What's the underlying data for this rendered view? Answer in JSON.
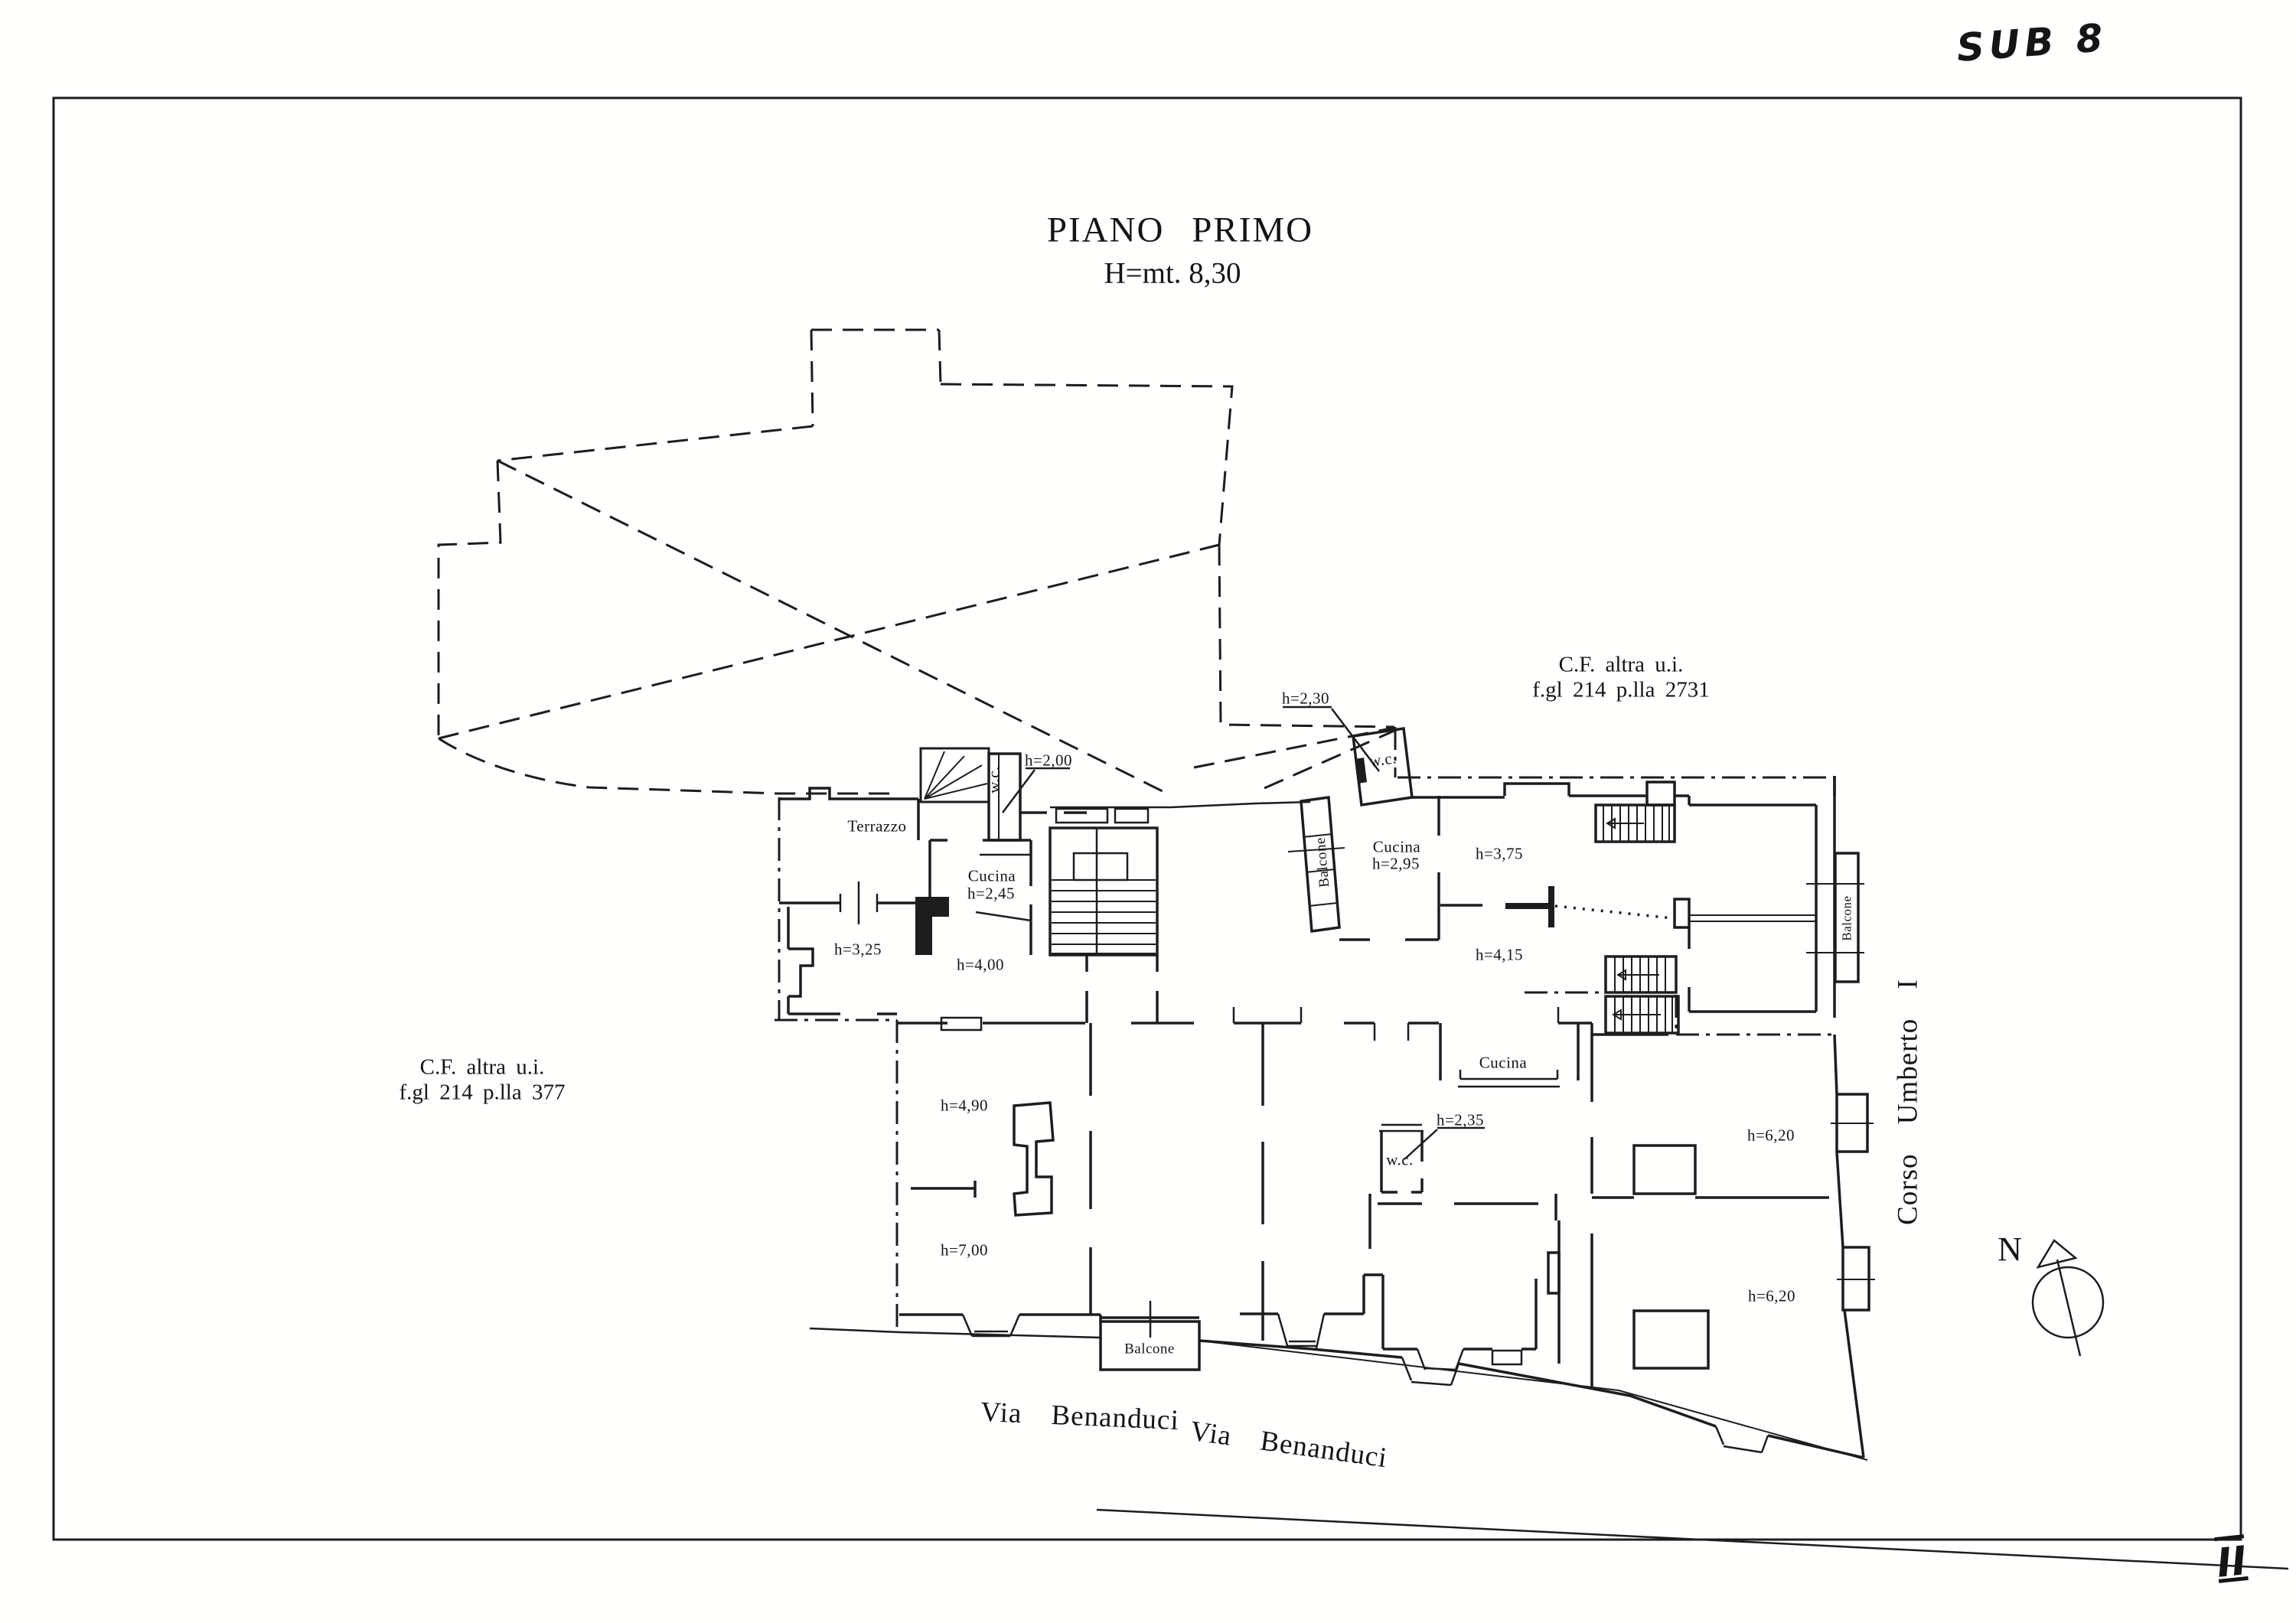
{
  "meta": {
    "ink": "#1d1d1d",
    "paper": "#fffffe"
  },
  "title": {
    "main": "PIANO PRIMO",
    "height_note": "H=mt. 8,30"
  },
  "annotations": {
    "sub_note": "SUB 8",
    "sheet_numeral": "II"
  },
  "cadastral": {
    "right": {
      "line1": "C.F.  altra u.i.",
      "line2": "f.gl 214 p.lla 2731"
    },
    "left": {
      "line1": "C.F.  altra u.i.",
      "line2": "f.gl 214 p.lla 377"
    }
  },
  "streets": {
    "via_benanduci_1": "Via  Benanduci",
    "via_benanduci_2": "Via  Benanduci",
    "corso_umberto": "Corso  Umberto  I"
  },
  "compass": {
    "label": "N"
  },
  "room_labels": [
    {
      "text": "Terrazzo"
    },
    {
      "text": "h=2,00"
    },
    {
      "text": "w.c."
    },
    {
      "text": "Cucina"
    },
    {
      "text": "h=2,45"
    },
    {
      "text": "h=3,25"
    },
    {
      "text": "h=4,00"
    },
    {
      "text": "h=2,30"
    },
    {
      "text": "w.c."
    },
    {
      "text": "Balcone"
    },
    {
      "text": "Cucina"
    },
    {
      "text": "h=2,95"
    },
    {
      "text": "h=3,75"
    },
    {
      "text": "h=4,15"
    },
    {
      "text": "Balcone"
    },
    {
      "text": "Cucina"
    },
    {
      "text": "h=2,35"
    },
    {
      "text": "w.c."
    },
    {
      "text": "h=4,90"
    },
    {
      "text": "h=7,00"
    },
    {
      "text": "Balcone"
    },
    {
      "text": "h=6,20"
    },
    {
      "text": "h=6,20"
    }
  ]
}
